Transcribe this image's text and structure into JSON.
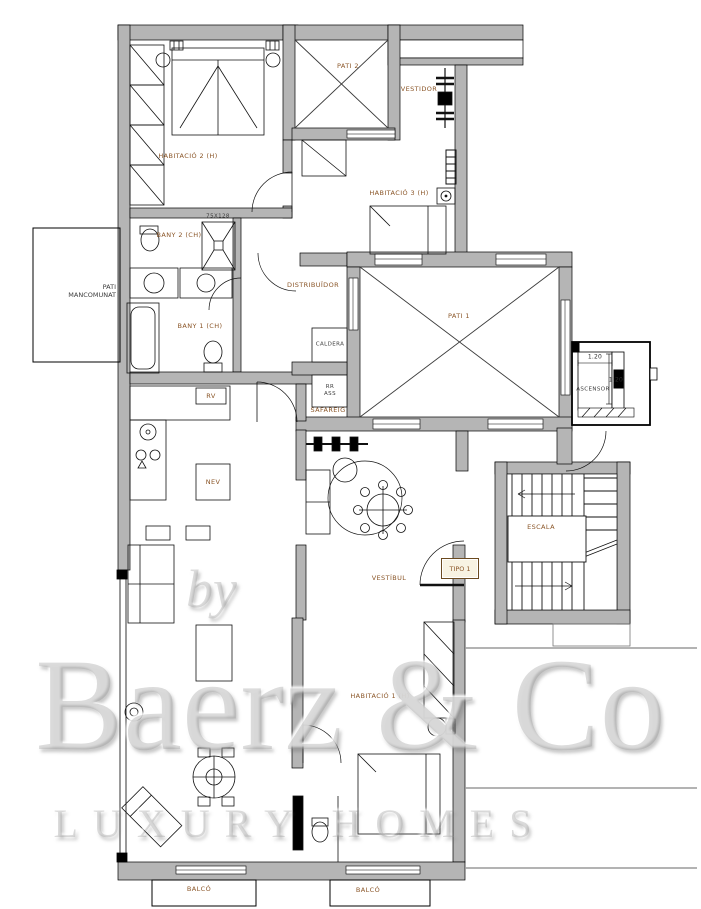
{
  "title": "Apartment floor plan (tipo 1)",
  "colors": {
    "wall": "#b5b5b5",
    "room_label": "#8a5527",
    "line": "#1a1a1a",
    "dim_text": "#2e2e2e"
  },
  "rooms": {
    "habitacio2": "HABITACIÓ 2 (H)",
    "pati2": "PATI 2",
    "vestidor": "VESTIDOR",
    "habitacio3": "HABITACIÓ 3 (H)",
    "bany2": "BANY 2 (CH)",
    "shower_dim": "75X128",
    "pati_mancomunat": "PATI\nMANCOMUNAT",
    "bany1": "BANY 1 (CH)",
    "distribuidor": "DISTRIBUÏDOR",
    "pati1": "PATI 1",
    "caldera": "CALDERA",
    "rr_ass": "RR\nASS",
    "safareig": "SAFAREIG",
    "rv": "RV",
    "nev": "NEV",
    "ascensor": "ASCENSOR",
    "dim_elevator_width": "1.20",
    "dim_elevator_depth": "1.20",
    "escala": "ESCALA",
    "tipo": "TIPO 1",
    "vestibul": "VESTÍBUL",
    "habitacio1": "HABITACIÓ 1 (H)",
    "balco_left": "BALCÓ",
    "balco_right": "BALCÓ"
  },
  "watermark": {
    "by": "by",
    "brand": "Baerz & Co",
    "tagline": "LUXURY HOMES"
  }
}
